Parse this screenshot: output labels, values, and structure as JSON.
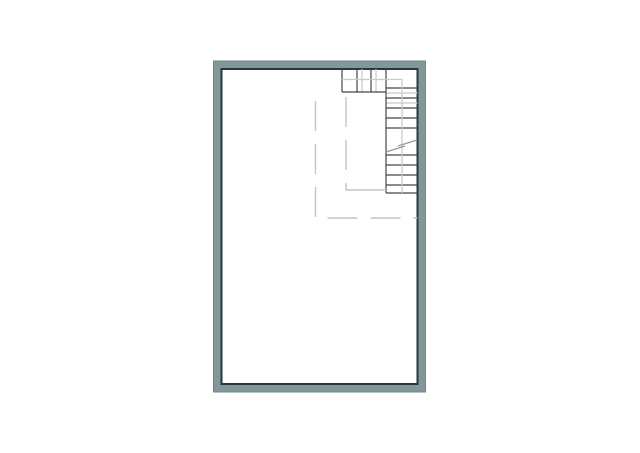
{
  "floor_plan": {
    "canvas": {
      "width": 640,
      "height": 453,
      "background": "#ffffff"
    },
    "colors": {
      "wall_fill": "#81989a",
      "wall_outer_line": "#6e8789",
      "wall_inner_line": "#27383a",
      "floor_fill": "#ffffff",
      "stair_dark_line": "#40484a",
      "stair_light_line": "#c5c9ca",
      "handrail_line": "#c5c9ca",
      "break_line": "#959b9c",
      "opening_dashed_line": "#c2c6c7"
    },
    "room": {
      "outer": {
        "x": 213.5,
        "y": 61,
        "w": 212,
        "h": 331
      },
      "inner": {
        "x": 221.5,
        "y": 69,
        "w": 196,
        "h": 315
      },
      "wall_thickness": 8
    },
    "staircase": {
      "top_run": {
        "band_top_y": 69,
        "band_bottom_y": 92,
        "dark_tread_xs": [
          342,
          357,
          371
        ],
        "light_tread_xs": [
          362,
          376
        ],
        "bottom_edge": {
          "x1": 342,
          "x2": 386,
          "y": 92
        }
      },
      "right_run": {
        "band_left_x": 386,
        "band_right_x": 417.5,
        "left_edge": {
          "x": 386,
          "y1": 69,
          "y2": 193
        },
        "bottom_edge": {
          "x1": 386,
          "x2": 417.5,
          "y": 193
        },
        "dark_tread_ys": [
          88,
          98,
          108,
          118,
          128,
          155,
          165,
          175,
          185
        ],
        "light_tread_ys": [
          93,
          103
        ]
      },
      "handrail_points": "342,79.5 402,79.5 402,193",
      "break_segments": [
        {
          "x1": 386,
          "y1": 152,
          "x2": 405,
          "y2": 146
        },
        {
          "x1": 398,
          "y1": 146,
          "x2": 417,
          "y2": 140
        }
      ]
    },
    "stair_opening": {
      "outer_dashed_points": "315.5,101 315.5,218 417.5,218",
      "inner_dashed_vertical": {
        "x": 346,
        "y1": 97,
        "y2": 190
      },
      "inner_solid_horizontal": {
        "x1": 346,
        "x2": 386,
        "y": 190
      },
      "dash_pattern": "30 13"
    }
  }
}
